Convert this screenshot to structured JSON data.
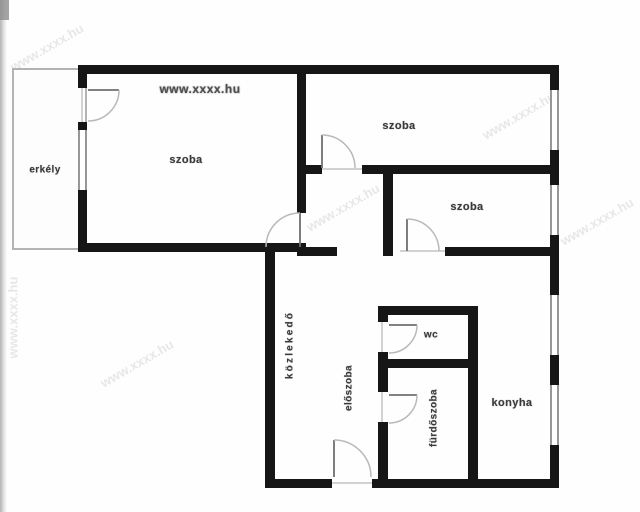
{
  "watermark": {
    "site_url": "www.xxxx.hu"
  },
  "rooms": {
    "balcony": {
      "label": "erkély"
    },
    "room_large": {
      "label": "szoba"
    },
    "room_top_right": {
      "label": "szoba"
    },
    "room_middle_right": {
      "label": "szoba"
    },
    "kitchen": {
      "label": "konyha"
    },
    "wc": {
      "label": "wc"
    },
    "bathroom": {
      "label": "fürdőszoba"
    },
    "corridor": {
      "label": "közlekedő"
    },
    "hall": {
      "label": "előszoba"
    }
  }
}
